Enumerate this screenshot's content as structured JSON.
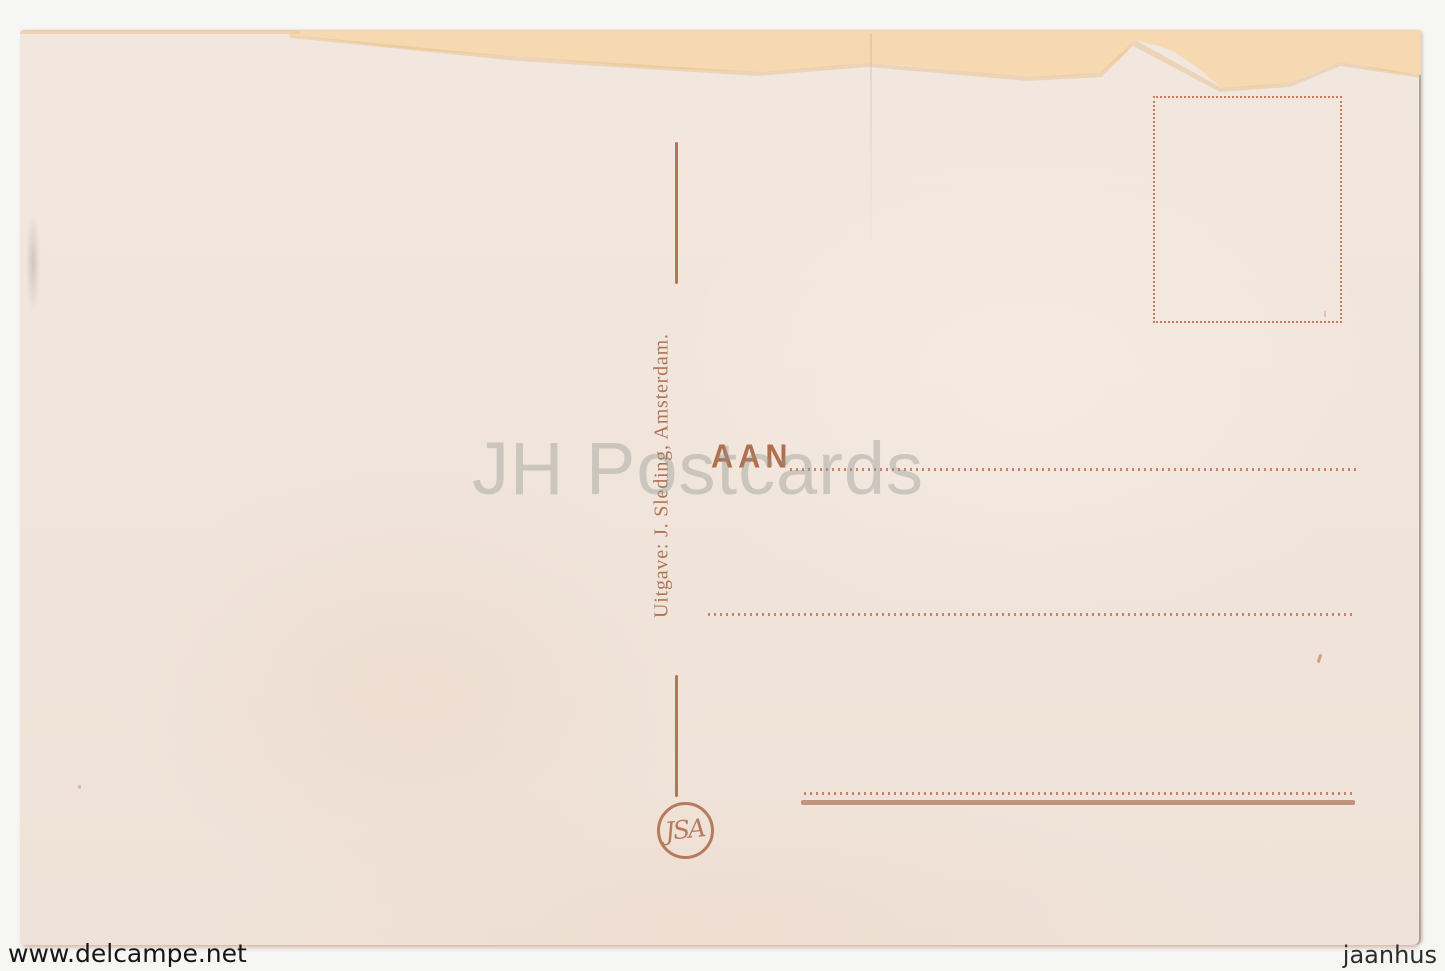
{
  "scan": {
    "watermark_text": "JH Postcards",
    "footer_left_credit": "www.delcampe.net",
    "footer_right_credit": "jaanhus"
  },
  "postcard": {
    "publisher_line": "Uitgave: J. Sleding, Amsterdam.",
    "address_label": "AAN",
    "logo_monogram": "JSA",
    "colors": {
      "ink": "#ab6a48",
      "paper": "#f0e5db",
      "torn_top_band": "#f6d9b0",
      "stamp_box_ink": "#c46a45",
      "dotted_rule_ink": "#bf7352",
      "solid_rule_ink": "#b98b72"
    }
  }
}
